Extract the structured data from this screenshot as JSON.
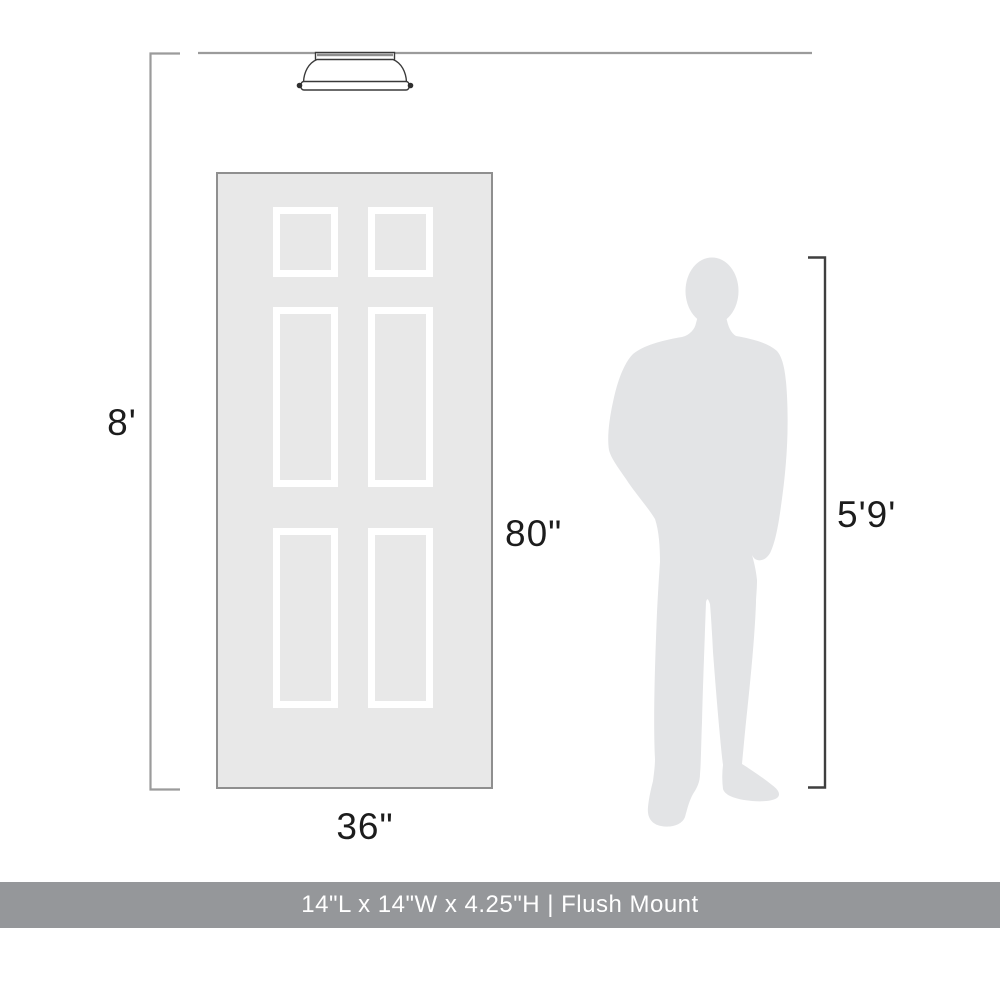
{
  "dimension_labels": {
    "ceiling_height": "8'",
    "door_height": "80\"",
    "door_width": "36\"",
    "person_height": "5'9'"
  },
  "product_banner": {
    "dimensions_text": "14\"L x 14\"W x 4.25\"H | Flush Mount"
  },
  "figures": {
    "fixture": "flush-mount-ceiling-light",
    "door": "six-panel-door",
    "door_panel_layout": "2x3",
    "person": "male-person-silhouette"
  },
  "colors": {
    "door_fill": "#e8e8e8",
    "door_border": "#8f8f8f",
    "panel_white": "#ffffff",
    "person_fill": "#e3e4e6",
    "line_light": "#9b9b9b",
    "line_dark": "#3f3f3f",
    "fixture_stroke": "#3a3a3a",
    "footer_bg": "#95979a",
    "footer_text": "#ffffff",
    "label_text": "#1c1c1c"
  }
}
